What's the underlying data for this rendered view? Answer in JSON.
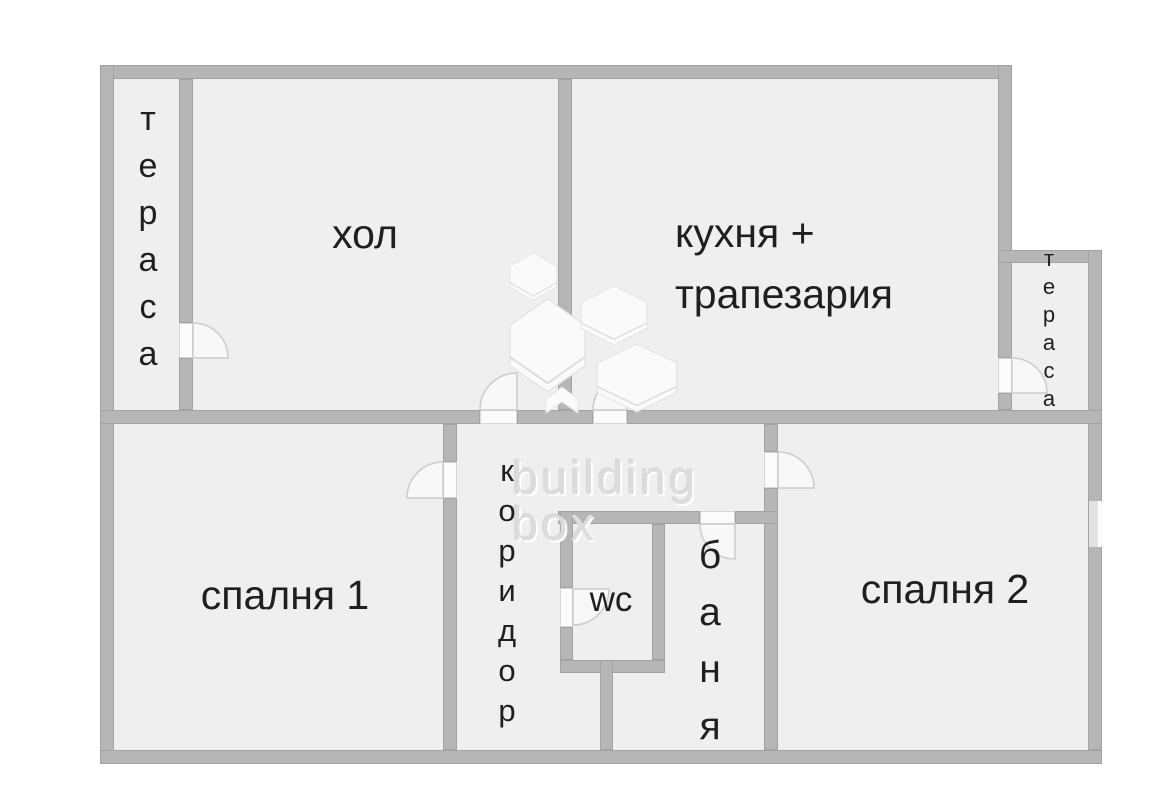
{
  "palette": {
    "room-fill": "#efefef",
    "wall": "#b6b6b6",
    "wall-edge": "#a3a3a3",
    "door-fill": "#fbfbfb",
    "door-edge": "#d6d6d6",
    "arc-stroke": "#cccccc",
    "label": "#1f1f1f",
    "watermark": "#dcdcdc"
  },
  "rooms": {
    "terrace_left": {
      "label": "тераса"
    },
    "living_room": {
      "label": "хол"
    },
    "kitchen": {
      "line1": "кухня +",
      "line2": "трапезария"
    },
    "terrace_right": {
      "label": "тераса"
    },
    "bedroom1": {
      "label": "спалня 1"
    },
    "corridor": {
      "label": "коридор"
    },
    "wc": {
      "label": "wc"
    },
    "bathroom": {
      "label": "баня"
    },
    "bedroom2": {
      "label": "спалня 2"
    }
  },
  "watermark": {
    "line1": "building",
    "line2": "box"
  }
}
